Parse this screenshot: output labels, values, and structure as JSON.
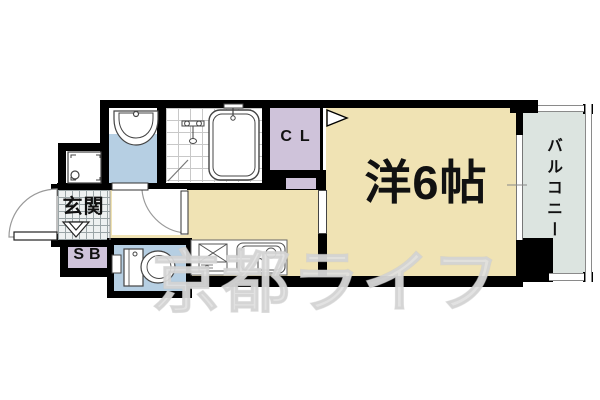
{
  "title": "apartment-floor-plan",
  "labels": {
    "entrance": "玄関",
    "shoe_box": "SB",
    "closet": "CL",
    "main_room": "洋6帖",
    "balcony": "バルコニー"
  },
  "watermark": {
    "text": "京都ライフ"
  },
  "colors": {
    "wall": "#000000",
    "room_beige": "#f0e3b4",
    "room_blue": "#b6cfe3",
    "room_purple": "#cfc3da",
    "balcony_gray": "#dce4e0",
    "watermark_gray": "#e3e3e3",
    "fixture_line": "#555555"
  },
  "fixtures": {
    "washbasin_icon": "washbasin",
    "bathtub_icon": "bathtub",
    "shower_icon": "shower-mixer",
    "washing_machine_icon": "washing-machine-pan",
    "toilet_icon": "toilet",
    "stove_icon": "gas-stove",
    "kitchen_sink_icon": "kitchen-sink",
    "entrance_door_icon": "entrance-door-swing",
    "hall_door_icon": "room-door-swing",
    "closet_door_icon": "closet-door",
    "window_icon": "sliding-window",
    "step_mark_icon": "entrance-step-mark",
    "door_marker_icon": "opening-triangle-marker"
  }
}
